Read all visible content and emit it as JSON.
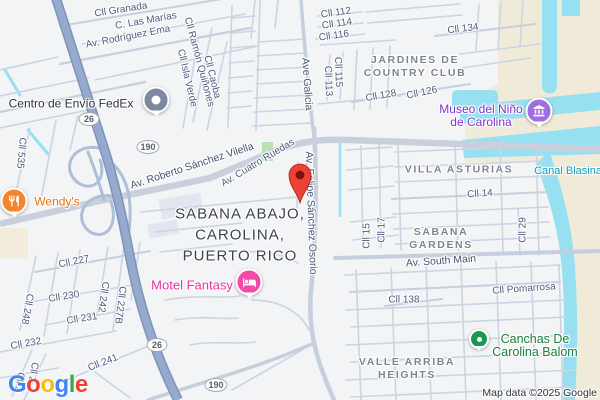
{
  "map": {
    "attribution": "Map data ©2025 Google",
    "locality": {
      "line1": "SABANA ABAJO,",
      "line2": "CAROLINA,",
      "line3": "PUERTO RICO"
    },
    "neighborhoods": {
      "jardines_line1": "JARDINES DE",
      "jardines_line2": "COUNTRY CLUB",
      "villa_asturias": "VILLA ASTURIAS",
      "sabana_line1": "SABANA",
      "sabana_line2": "GARDENS",
      "valle_line1": "VALLE ARRIBA",
      "valle_line2": "HEIGHTS"
    },
    "water_labels": {
      "canal_blasina": "Canal Blasina"
    },
    "streets": {
      "granada": "Cll Granada",
      "las_marias": "C. Las Marías",
      "rodriguez_ema": "Av. Rodríguez Ema",
      "ramon_quinones": "Cll Ramón Quiñones",
      "isla_verde": "Cll Isla Verde",
      "caoba": "Cll Caoba",
      "c535": "Cll 535",
      "roberto": "Av. Roberto Sánchez Vilella",
      "cuatro": "Av. Cuatro Ruedas",
      "galicia": "Ave Galicia",
      "felipe": "Av. Felipe Sánchez Osorio",
      "c112": "Cll 112",
      "c114": "Cll 114",
      "c116": "Cll 116",
      "c115": "Cll 115",
      "c113": "Cll 113",
      "c128": "Cll 128",
      "c126": "Cll 126",
      "c134": "Cll 134",
      "c14": "Cll 14",
      "c15": "Cll 15",
      "c17": "Cll 17",
      "c29": "Cll 29",
      "south_main": "Av. South Main",
      "pomarrosa": "Cll Pomarrosa",
      "c138": "Cll 138",
      "c227": "Cll 227",
      "c230": "Cll 230",
      "c231": "Cll 231",
      "c232": "Cll 232",
      "c241": "Cll 241",
      "c242": "Cll 242",
      "c227b": "Cll 227B",
      "c248": "Cll 248",
      "c2a": "Cll 2",
      "c2b": "Cll 2"
    },
    "route_badges": {
      "b26a": "26",
      "b190a": "190",
      "b26b": "26",
      "b190b": "190"
    },
    "pois": {
      "fedex": {
        "label": "Centro de Envío FedEx",
        "color": "#2a323f",
        "pin_color": "#7b8aa0"
      },
      "wendys": {
        "label": "Wendy's",
        "color": "#e8710a",
        "pin_color": "#f1862f"
      },
      "motel": {
        "label": "Motel Fantasy",
        "color": "#f02fa5",
        "pin_color": "#f24ba8"
      },
      "museo": {
        "line1": "Museo del Niño",
        "line2": "de Carolina",
        "color": "#8430ce",
        "pin_color": "#a06ee3"
      },
      "canchas": {
        "line1": "Canchas De",
        "line2": "Carolina Balom",
        "color": "#188038",
        "pin_color": "#17994f"
      },
      "destination_pin_color": "#EA4335"
    },
    "colors": {
      "water": "#97e0f1",
      "sand": "#f0ebd9",
      "park": "#b9e2b4",
      "highway": "#96aacd",
      "road_minor": "#ccd4e2"
    },
    "logo": {
      "text": "Google",
      "letter_colors": [
        "#4285F4",
        "#EA4335",
        "#FBBC05",
        "#4285F4",
        "#34A853",
        "#EA4335"
      ]
    }
  }
}
